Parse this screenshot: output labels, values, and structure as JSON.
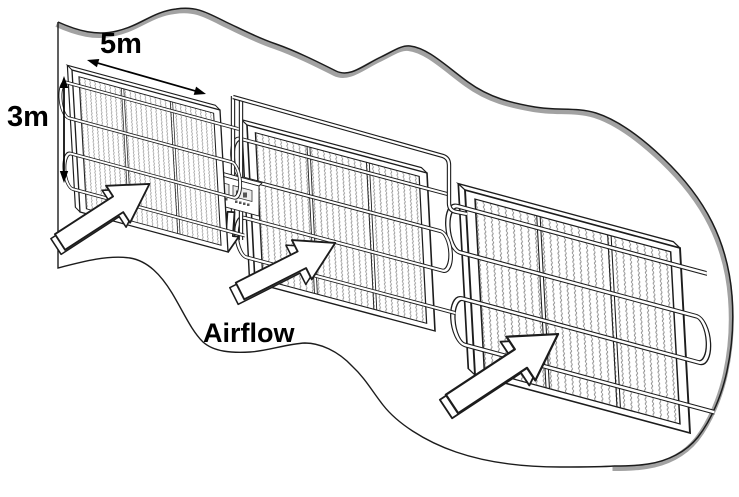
{
  "diagram": {
    "type": "technical-line-illustration",
    "scene": "Three wire-mesh panels with serpentine pipe coils and a control unit inside a wavy cut-out boundary",
    "labels": {
      "panel_width": "5m",
      "panel_height": "3m",
      "airflow": "Airflow"
    },
    "colors": {
      "background": "#ffffff",
      "line": "#1c1c1c",
      "boundary_shadow": "#a2a2a2",
      "mesh": "#8e8e8e",
      "text": "#000000",
      "arrow_fill": "#ffffff"
    },
    "panels": [
      {
        "id": "panel-1",
        "mesh_columns": 3,
        "tube_rows": 4
      },
      {
        "id": "panel-2",
        "mesh_columns": 3,
        "tube_rows": 4
      },
      {
        "id": "panel-3",
        "mesh_columns": 3,
        "tube_rows": 4
      }
    ],
    "device": {
      "id": "control-unit",
      "displays": 2
    },
    "icons": {
      "airflow_arrows": "block-arrow-up-right",
      "extraction_arrow": "block-arrow-down",
      "width_dimension": "double-headed-arrow-diagonal",
      "height_dimension": "double-headed-arrow-vertical"
    }
  }
}
